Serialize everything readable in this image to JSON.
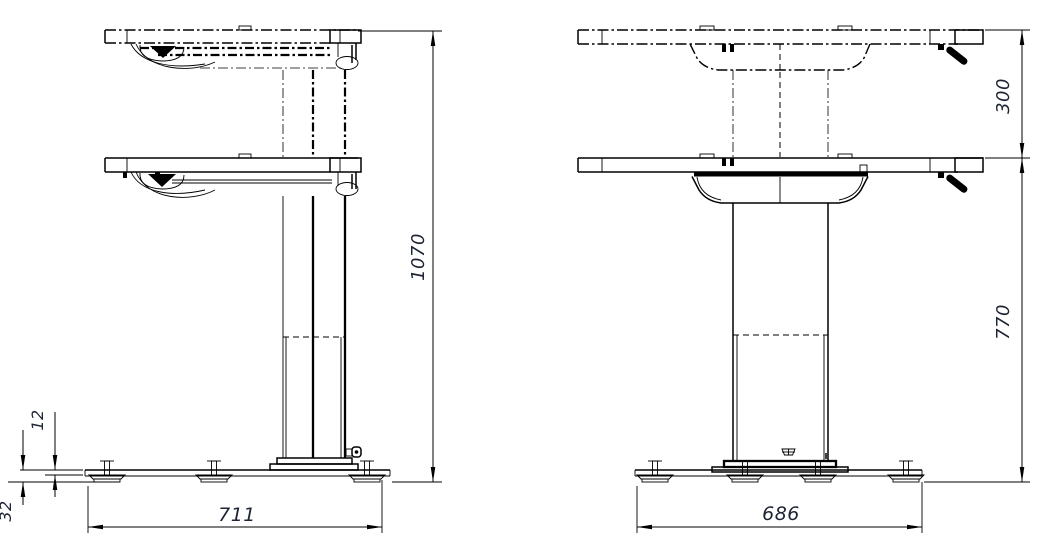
{
  "drawing": {
    "background": "#ffffff",
    "line_color": "#000000",
    "dimension_text_color": "#1d2433"
  },
  "side_view": {
    "name": "side view",
    "dimensions": {
      "overall_height": "1070",
      "base_length": "711",
      "rail_thickness": "12",
      "base_height": "32"
    }
  },
  "front_view": {
    "name": "front view",
    "dimensions": {
      "lift_travel": "300",
      "lowered_height": "770",
      "base_length": "686"
    }
  }
}
